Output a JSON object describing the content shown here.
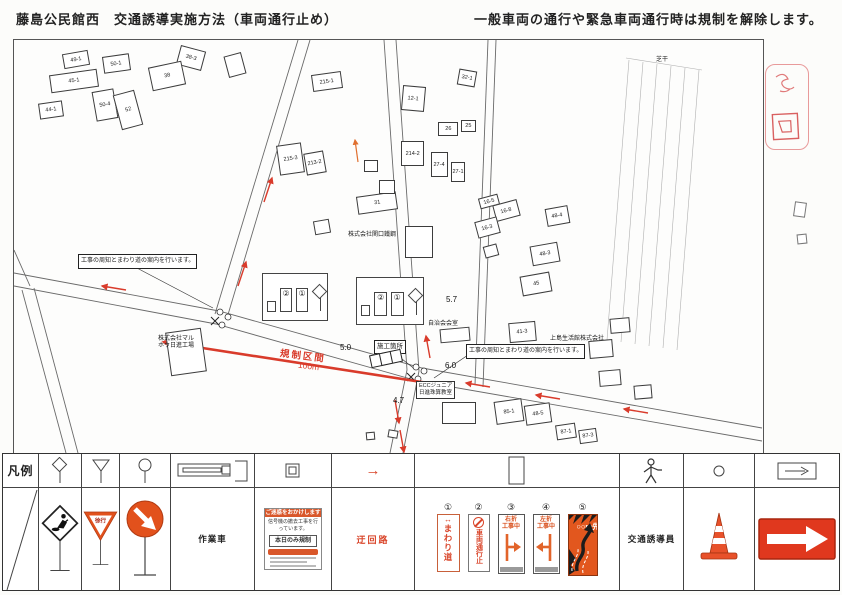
{
  "header": {
    "title": "藤島公民館西　交通誘導実施方法（車両通行止め）",
    "note": "一般車両の通行や緊急車両通行時は規制を解除します。"
  },
  "map": {
    "callout1": "工事の周知とまわり道の案内を行います。",
    "callout2": "工事の周知とまわり道の案内を行います。",
    "site_label": "施工箇所",
    "regulation": {
      "zone": "規制区間",
      "length": "100m"
    },
    "inset": {
      "sign2": "②",
      "sign1": "①"
    },
    "school": {
      "line1": "ECCジュニア",
      "line2": "日進珠算教室"
    },
    "widths": [
      {
        "t": "5.0",
        "x": 326,
        "y": 303
      },
      {
        "t": "5.7",
        "x": 432,
        "y": 255
      },
      {
        "t": "6.0",
        "x": 431,
        "y": 321
      },
      {
        "t": "4.7",
        "x": 379,
        "y": 356
      }
    ],
    "texts": [
      {
        "t": "株式会社マル",
        "x": 144,
        "y": 296
      },
      {
        "t": "ホウ日進工場",
        "x": 144,
        "y": 303
      },
      {
        "t": "株式会社関口鐵鋼",
        "x": 334,
        "y": 192
      },
      {
        "t": "上島生活館株式会社",
        "x": 536,
        "y": 296
      },
      {
        "t": "自治会会室",
        "x": 414,
        "y": 281
      },
      {
        "t": "芝干",
        "x": 642,
        "y": 17
      }
    ],
    "buildings": [
      {
        "x": 49,
        "y": 12,
        "w": 26,
        "h": 15,
        "r": -10,
        "l": "49-1"
      },
      {
        "x": 89,
        "y": 15,
        "w": 27,
        "h": 17,
        "r": -8,
        "l": "50-1"
      },
      {
        "x": 164,
        "y": 8,
        "w": 26,
        "h": 20,
        "r": 15,
        "l": "38-3"
      },
      {
        "x": 36,
        "y": 32,
        "w": 48,
        "h": 18,
        "r": -8,
        "l": "45-1"
      },
      {
        "x": 136,
        "y": 24,
        "w": 34,
        "h": 24,
        "r": -12,
        "l": "38"
      },
      {
        "x": 80,
        "y": 50,
        "w": 22,
        "h": 30,
        "r": -10,
        "l": "50-4"
      },
      {
        "x": 25,
        "y": 62,
        "w": 24,
        "h": 16,
        "r": -8,
        "l": "44-1"
      },
      {
        "x": 103,
        "y": 52,
        "w": 22,
        "h": 36,
        "r": -15,
        "l": "52"
      },
      {
        "x": 212,
        "y": 14,
        "w": 18,
        "h": 22,
        "r": -15,
        "l": ""
      },
      {
        "x": 298,
        "y": 33,
        "w": 30,
        "h": 17,
        "r": -8,
        "l": "215-1"
      },
      {
        "x": 388,
        "y": 46,
        "w": 23,
        "h": 25,
        "r": 5,
        "l": "12-1"
      },
      {
        "x": 444,
        "y": 30,
        "w": 18,
        "h": 16,
        "r": 10,
        "l": "32-1"
      },
      {
        "x": 424,
        "y": 82,
        "w": 20,
        "h": 14,
        "r": 0,
        "l": "26"
      },
      {
        "x": 447,
        "y": 80,
        "w": 15,
        "h": 12,
        "r": 0,
        "l": "25"
      },
      {
        "x": 264,
        "y": 104,
        "w": 25,
        "h": 30,
        "r": -8,
        "l": "215-3"
      },
      {
        "x": 291,
        "y": 112,
        "w": 20,
        "h": 22,
        "r": -10,
        "l": "213-2"
      },
      {
        "x": 387,
        "y": 101,
        "w": 23,
        "h": 25,
        "r": 0,
        "l": "214-2"
      },
      {
        "x": 417,
        "y": 112,
        "w": 17,
        "h": 25,
        "r": 0,
        "l": "27-4"
      },
      {
        "x": 437,
        "y": 122,
        "w": 14,
        "h": 20,
        "r": 0,
        "l": "27-1"
      },
      {
        "x": 343,
        "y": 154,
        "w": 40,
        "h": 18,
        "r": -8,
        "l": "31"
      },
      {
        "x": 465,
        "y": 156,
        "w": 20,
        "h": 11,
        "r": -15,
        "l": "16-5"
      },
      {
        "x": 480,
        "y": 162,
        "w": 25,
        "h": 17,
        "r": -15,
        "l": "16-8"
      },
      {
        "x": 462,
        "y": 179,
        "w": 23,
        "h": 17,
        "r": -15,
        "l": "16-3"
      },
      {
        "x": 532,
        "y": 167,
        "w": 23,
        "h": 18,
        "r": -10,
        "l": "48-4"
      },
      {
        "x": 517,
        "y": 204,
        "w": 28,
        "h": 20,
        "r": -10,
        "l": "48-3"
      },
      {
        "x": 507,
        "y": 234,
        "w": 30,
        "h": 20,
        "r": -10,
        "l": "45"
      },
      {
        "x": 391,
        "y": 186,
        "w": 28,
        "h": 32,
        "r": 0,
        "l": ""
      },
      {
        "x": 426,
        "y": 288,
        "w": 30,
        "h": 14,
        "r": -5,
        "l": ""
      },
      {
        "x": 495,
        "y": 282,
        "w": 27,
        "h": 20,
        "r": -5,
        "l": "41-3"
      },
      {
        "x": 575,
        "y": 300,
        "w": 24,
        "h": 18,
        "r": -5,
        "l": ""
      },
      {
        "x": 596,
        "y": 278,
        "w": 20,
        "h": 15,
        "r": -5,
        "l": ""
      },
      {
        "x": 154,
        "y": 290,
        "w": 36,
        "h": 44,
        "r": -8,
        "l": ""
      },
      {
        "x": 428,
        "y": 362,
        "w": 34,
        "h": 22,
        "r": 0,
        "l": ""
      },
      {
        "x": 481,
        "y": 360,
        "w": 28,
        "h": 23,
        "r": -8,
        "l": "85-1"
      },
      {
        "x": 511,
        "y": 364,
        "w": 26,
        "h": 20,
        "r": -8,
        "l": "48-5"
      },
      {
        "x": 542,
        "y": 384,
        "w": 20,
        "h": 15,
        "r": -8,
        "l": "87-1"
      },
      {
        "x": 565,
        "y": 389,
        "w": 18,
        "h": 14,
        "r": -8,
        "l": "87-3"
      },
      {
        "x": 300,
        "y": 180,
        "w": 16,
        "h": 14,
        "r": -10,
        "l": ""
      },
      {
        "x": 350,
        "y": 120,
        "w": 14,
        "h": 12,
        "r": 0,
        "l": ""
      },
      {
        "x": 365,
        "y": 140,
        "w": 16,
        "h": 14,
        "r": 0,
        "l": ""
      },
      {
        "x": 470,
        "y": 205,
        "w": 14,
        "h": 12,
        "r": -15,
        "l": ""
      },
      {
        "x": 585,
        "y": 330,
        "w": 22,
        "h": 16,
        "r": -5,
        "l": ""
      },
      {
        "x": 620,
        "y": 345,
        "w": 18,
        "h": 14,
        "r": -5,
        "l": ""
      },
      {
        "x": 374,
        "y": 390,
        "w": 10,
        "h": 8,
        "r": 10,
        "l": ""
      },
      {
        "x": 352,
        "y": 392,
        "w": 9,
        "h": 8,
        "r": -5,
        "l": ""
      }
    ]
  },
  "legend": {
    "title": "凡例",
    "work_vehicle": "作業車",
    "detour_route": "迂回路",
    "traffic_guide": "交通誘導員",
    "slow_sign": "徐行",
    "notice": {
      "header": "ご迷惑をおかけします",
      "body": "信号機の撤去工事を行っています。",
      "box": "本日のみ規制"
    },
    "signs": [
      {
        "no": "①",
        "text": "まわり道"
      },
      {
        "no": "②",
        "text": "車両通行止"
      },
      {
        "no": "③",
        "line1": "右折",
        "line2": "工事中"
      },
      {
        "no": "④",
        "line1": "左折",
        "line2": "工事中"
      },
      {
        "no": "⑤",
        "text": "○○m先"
      }
    ]
  }
}
